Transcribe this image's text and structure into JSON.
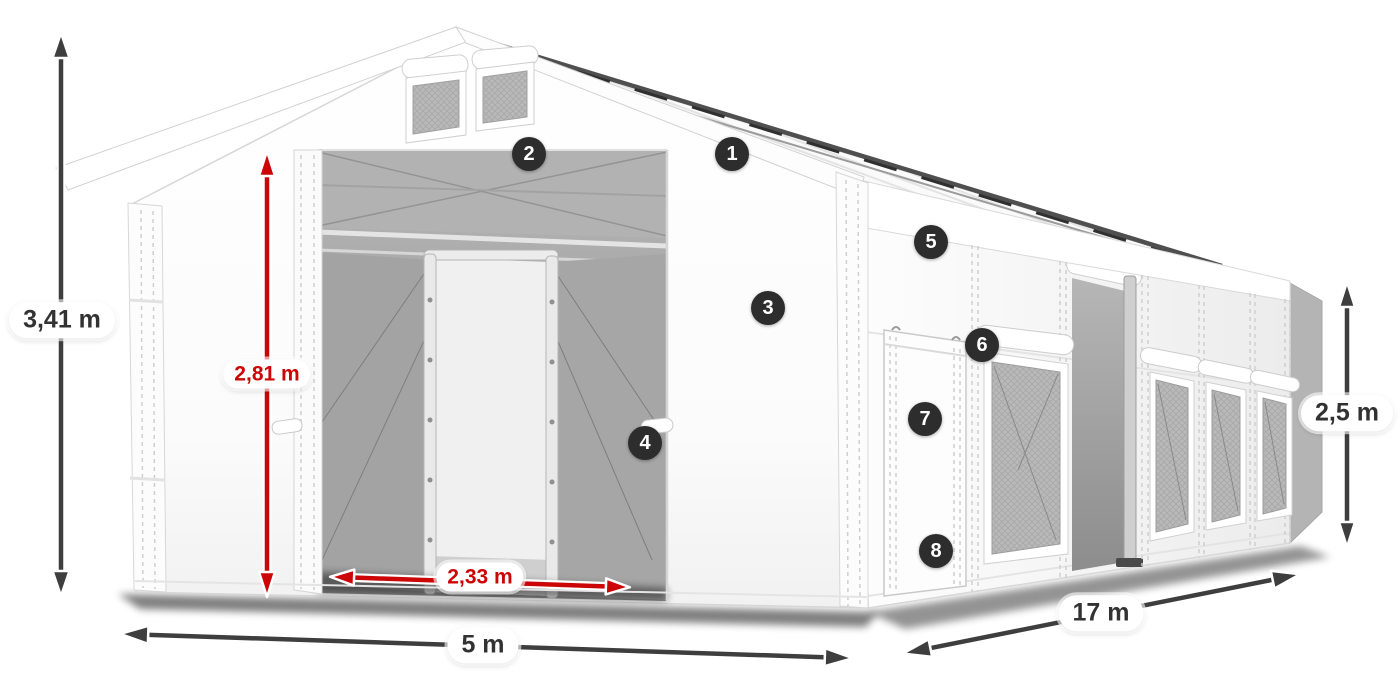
{
  "figure": {
    "subject": "white-storage-tent-diagram"
  },
  "colors": {
    "arrow_dark": "#3e3e3e",
    "red_accent": "#cc0606",
    "badge_bg": "#2d2d2d",
    "badge_text": "#ffffff",
    "pill_bg": "#ffffff",
    "dim_text": "#323232",
    "tent_white": "#ffffff",
    "interior_gray": "#a3a3a3"
  },
  "dimensions": {
    "total_height": {
      "value": "3,41 m"
    },
    "door_height": {
      "value": "2,81 m"
    },
    "door_width": {
      "value": "2,33 m"
    },
    "front_width": {
      "value": "5 m"
    },
    "length": {
      "value": "17 m"
    },
    "side_height": {
      "value": "2,5 m"
    }
  },
  "hotspots": [
    {
      "number": "1"
    },
    {
      "number": "2"
    },
    {
      "number": "3"
    },
    {
      "number": "4"
    },
    {
      "number": "5"
    },
    {
      "number": "6"
    },
    {
      "number": "7"
    },
    {
      "number": "8"
    }
  ]
}
